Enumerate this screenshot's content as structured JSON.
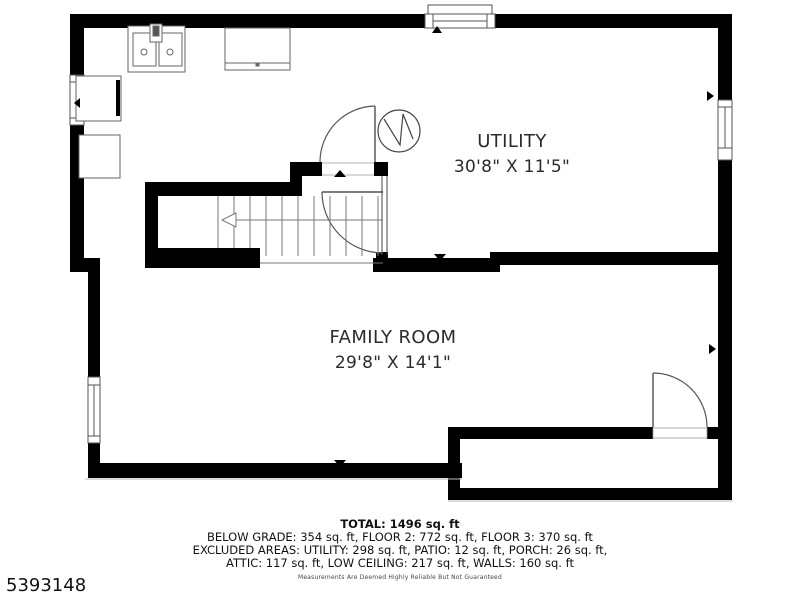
{
  "colors": {
    "wall": "#000000",
    "background": "#ffffff",
    "fixture_line": "#666666",
    "door_line": "#555555",
    "text": "#2b2b2b"
  },
  "rooms": [
    {
      "name": "UTILITY",
      "dimensions": "30'8\" X 11'5\""
    },
    {
      "name": "FAMILY ROOM",
      "dimensions": "29'8\" X 14'1\""
    }
  ],
  "summary": {
    "total": "TOTAL: 1496 sq. ft",
    "line1": "BELOW GRADE: 354 sq. ft, FLOOR 2: 772 sq. ft, FLOOR 3: 370 sq. ft",
    "line2": "EXCLUDED AREAS: UTILITY: 298 sq. ft, PATIO: 12 sq. ft, PORCH: 26 sq. ft,",
    "line3": "ATTIC: 117 sq. ft, LOW CEILING: 217 sq. ft, WALLS: 160 sq. ft",
    "disclaimer": "Measurements Are Deemed Highly Reliable But Not Guaranteed"
  },
  "listing_id": "5393148"
}
